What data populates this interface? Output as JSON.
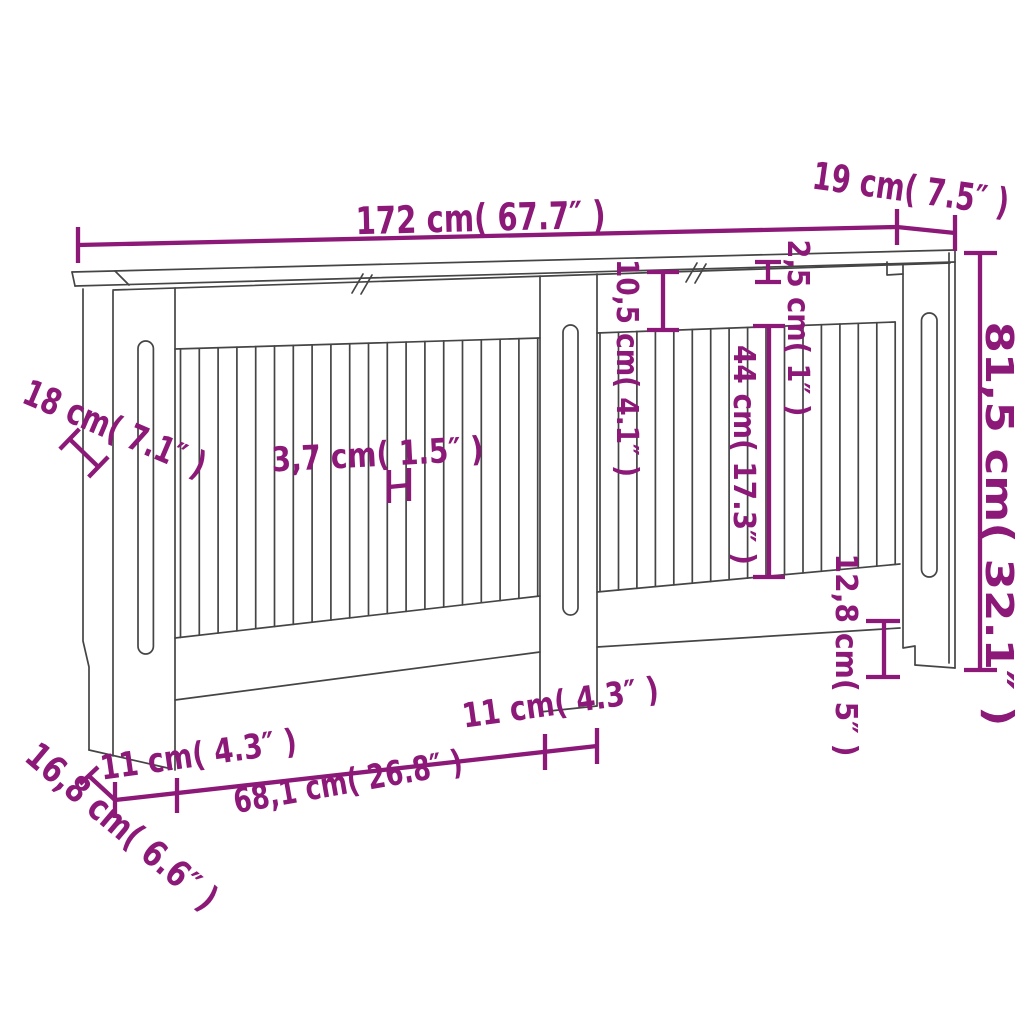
{
  "figure": {
    "description": "Line-drawing dimension diagram of an MDF radiator cover cabinet with vertical slats, two slotted side posts, a slotted center post and a top shelf",
    "colors": {
      "annotation": "#8C1878",
      "drawing_line": "#454545",
      "background": "#FFFFFF"
    },
    "units": [
      "cm",
      "inch"
    ],
    "dimensions": [
      {
        "name": "total-width",
        "cm": "172",
        "inch": "67.7",
        "label": "172 cm( 67.7″ )"
      },
      {
        "name": "top-depth",
        "cm": "19",
        "inch": "7.5",
        "label": "19 cm( 7.5″ )"
      },
      {
        "name": "total-height",
        "cm": "81,5",
        "inch": "32.1",
        "label": "81,5 cm( 32.1″ )"
      },
      {
        "name": "side-depth",
        "cm": "18",
        "inch": "7.1",
        "label": "18 cm( 7.1″ )"
      },
      {
        "name": "slat-width",
        "cm": "3,7",
        "inch": "1.5",
        "label": "3,7 cm( 1.5″ )"
      },
      {
        "name": "top-rail-height",
        "cm": "10,5",
        "inch": "4.1",
        "label": "10,5 cm( 4.1″ )"
      },
      {
        "name": "top-thickness",
        "cm": "2,5",
        "inch": "1",
        "label": "2,5 cm( 1″ )"
      },
      {
        "name": "slat-height",
        "cm": "44",
        "inch": "17.3",
        "label": "44 cm( 17.3″ )"
      },
      {
        "name": "foot-height",
        "cm": "12,8",
        "inch": "5",
        "label": "12,8 cm( 5″ )"
      },
      {
        "name": "left-post-width",
        "cm": "11",
        "inch": "4.3",
        "label": "11 cm( 4.3″ )"
      },
      {
        "name": "slat-section-width",
        "cm": "68,1",
        "inch": "26.8",
        "label": "68,1 cm( 26.8″ )"
      },
      {
        "name": "center-post-width",
        "cm": "11",
        "inch": "4.3",
        "label": "11 cm( 4.3″ )"
      },
      {
        "name": "base-depth",
        "cm": "16,8",
        "inch": "6.6",
        "label": "16,8 cm( 6.6″ )"
      }
    ]
  }
}
